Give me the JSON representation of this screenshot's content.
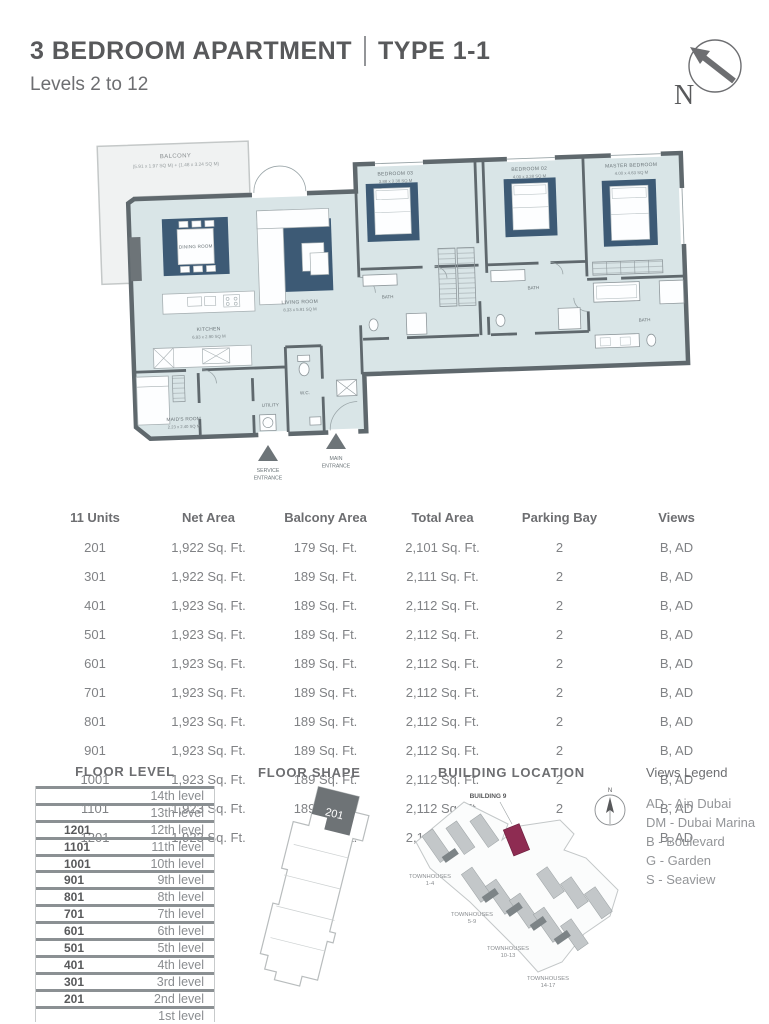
{
  "header": {
    "title": "3 BEDROOM APARTMENT",
    "type_label": "TYPE 1-1",
    "subtitle": "Levels 2 to 12",
    "compass_label": "N"
  },
  "floor_plan": {
    "balcony": {
      "name": "BALCONY",
      "dims": "(5.91 x 1.97 SQ M) + (1.48 x 3.24 SQ M)"
    },
    "rooms": {
      "dining": {
        "name": "DINING ROOM"
      },
      "living": {
        "name": "LIVING ROOM",
        "dims": "8.33 x 5.91 SQ M"
      },
      "kitchen": {
        "name": "KITCHEN",
        "dims": "6.93 x 2.90 SQ M"
      },
      "maids": {
        "name": "MAID'S ROOM",
        "dims": "2.23 x 2.40 SQ M"
      },
      "bedroom3": {
        "name": "BEDROOM 03",
        "dims": "3.88 x 3.38 SQ M"
      },
      "bedroom2": {
        "name": "BEDROOM 02",
        "dims": "4.00 x 3.38 SQ M"
      },
      "master": {
        "name": "MASTER BEDROOM",
        "dims": "4.00 x 4.63 SQ M"
      },
      "bath": "BATH",
      "wc": "W.C.",
      "utility": "UTILITY"
    },
    "entrances": {
      "service": [
        "SERVICE",
        "ENTRANCE"
      ],
      "main": [
        "MAIN",
        "ENTRANCE"
      ]
    }
  },
  "units_table": {
    "headers": [
      "11 Units",
      "Net Area",
      "Balcony Area",
      "Total Area",
      "Parking Bay",
      "Views"
    ],
    "rows": [
      [
        "201",
        "1,922 Sq. Ft.",
        "179 Sq. Ft.",
        "2,101 Sq. Ft.",
        "2",
        "B, AD"
      ],
      [
        "301",
        "1,922 Sq. Ft.",
        "189 Sq. Ft.",
        "2,111 Sq. Ft.",
        "2",
        "B, AD"
      ],
      [
        "401",
        "1,923 Sq. Ft.",
        "189 Sq. Ft.",
        "2,112 Sq. Ft.",
        "2",
        "B, AD"
      ],
      [
        "501",
        "1,923 Sq. Ft.",
        "189 Sq. Ft.",
        "2,112 Sq. Ft.",
        "2",
        "B, AD"
      ],
      [
        "601",
        "1,923 Sq. Ft.",
        "189 Sq. Ft.",
        "2,112 Sq. Ft.",
        "2",
        "B, AD"
      ],
      [
        "701",
        "1,923 Sq. Ft.",
        "189 Sq. Ft.",
        "2,112 Sq. Ft.",
        "2",
        "B, AD"
      ],
      [
        "801",
        "1,923 Sq. Ft.",
        "189 Sq. Ft.",
        "2,112 Sq. Ft.",
        "2",
        "B, AD"
      ],
      [
        "901",
        "1,923 Sq. Ft.",
        "189 Sq. Ft.",
        "2,112 Sq. Ft.",
        "2",
        "B, AD"
      ],
      [
        "1001",
        "1,923 Sq. Ft.",
        "189 Sq. Ft.",
        "2,112 Sq. Ft.",
        "2",
        "B, AD"
      ],
      [
        "1101",
        "1,923 Sq. Ft.",
        "189 Sq. Ft.",
        "2,112 Sq. Ft.",
        "2",
        "B, AD"
      ],
      [
        "1201",
        "1,923 Sq. Ft.",
        "189 Sq. Ft.",
        "2,112 Sq. Ft.",
        "2",
        "B, AD"
      ]
    ]
  },
  "floor_level": {
    "title": "FLOOR LEVEL",
    "rows": [
      {
        "unit": "",
        "level": "14th level"
      },
      {
        "unit": "",
        "level": "13th level"
      },
      {
        "unit": "1201",
        "level": "12th level"
      },
      {
        "unit": "1101",
        "level": "11th level"
      },
      {
        "unit": "1001",
        "level": "10th level"
      },
      {
        "unit": "901",
        "level": "9th level"
      },
      {
        "unit": "801",
        "level": "8th level"
      },
      {
        "unit": "701",
        "level": "7th level"
      },
      {
        "unit": "601",
        "level": "6th level"
      },
      {
        "unit": "501",
        "level": "5th level"
      },
      {
        "unit": "401",
        "level": "4th level"
      },
      {
        "unit": "301",
        "level": "3rd level"
      },
      {
        "unit": "201",
        "level": "2nd level"
      },
      {
        "unit": "",
        "level": "1st level"
      }
    ]
  },
  "floor_shape": {
    "title": "FLOOR SHAPE",
    "highlight_label": "201"
  },
  "building_location": {
    "title": "BUILDING LOCATION",
    "building_label": "BUILDING 9",
    "compass_label": "N",
    "townhouses": [
      [
        "TOWNHOUSES",
        "1-4"
      ],
      [
        "TOWNHOUSES",
        "5-9"
      ],
      [
        "TOWNHOUSES",
        "10-13"
      ],
      [
        "TOWNHOUSES",
        "14-17"
      ]
    ]
  },
  "views_legend": {
    "title": "Views Legend",
    "items": [
      "AD - Ain Dubai",
      "DM - Dubai Marina",
      "B - Boulevard",
      "G - Garden",
      "S - Seaview"
    ]
  },
  "colors": {
    "accent_blue": "#3d5a75",
    "floor": "#d9e5e7",
    "wall": "#5f686d",
    "highlight_magenta": "#8e2c52"
  }
}
